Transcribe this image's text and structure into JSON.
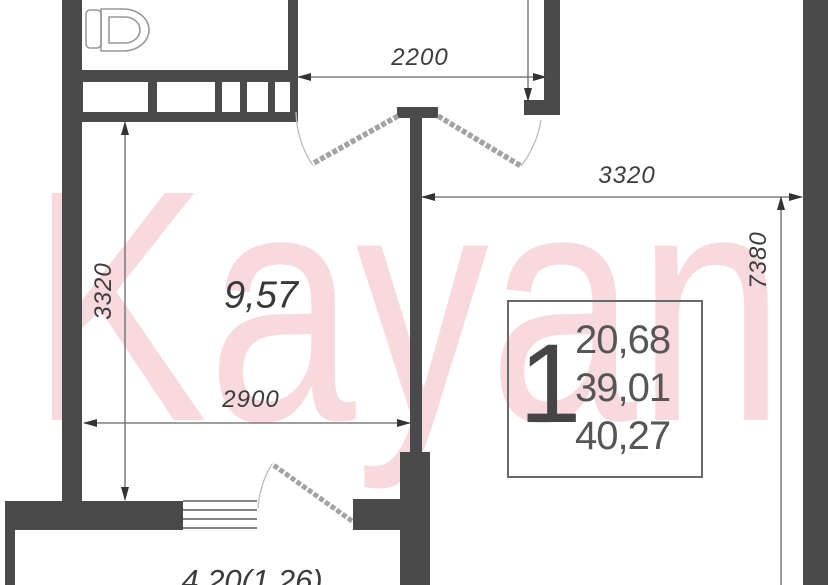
{
  "watermark": {
    "text": "Kayan"
  },
  "plan": {
    "room_label": "9,57",
    "balcony_label": "4,20(1,26)",
    "dims": {
      "top_opening_width": "2200",
      "left_room_height": "3320",
      "room_width": "2900",
      "right_room_width": "3320",
      "right_total_height": "7380"
    },
    "info_box": {
      "rooms": "1",
      "living_area": "20,68",
      "area_no_balcony": "39,01",
      "total_area": "40,27"
    }
  },
  "colors": {
    "wall": "#4a4a4a",
    "thin_line": "#666666",
    "dim_text": "#3c3c3c",
    "door_leaf": "#a3a3a3",
    "door_arc": "#b8b8b8",
    "watermark_pink": "#f8d9de",
    "box_border": "#696969"
  }
}
